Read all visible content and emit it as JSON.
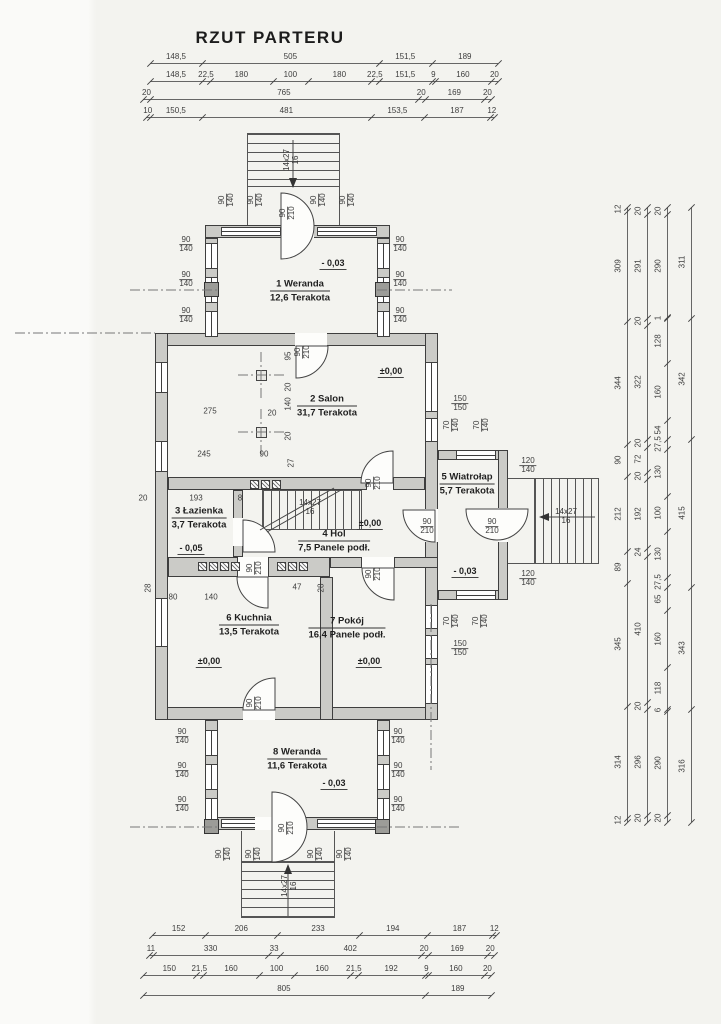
{
  "title": "RZUT PARTERU",
  "colors": {
    "line": "#3e3e3e",
    "wall_fill": "#cbcbc7",
    "paper": "#f3f3ef"
  },
  "rooms": [
    {
      "name": "1 Weranda",
      "detail": "12,6 Terakota",
      "x": 300,
      "y": 291
    },
    {
      "name": "2 Salon",
      "detail": "31,7 Terakota",
      "x": 327,
      "y": 406
    },
    {
      "name": "3 Łazienka",
      "detail": "3,7 Terakota",
      "x": 199,
      "y": 518
    },
    {
      "name": "4 Hol",
      "detail": "7,5 Panele podł.",
      "x": 334,
      "y": 541
    },
    {
      "name": "5 Wiatrołap",
      "detail": "5,7 Terakota",
      "x": 467,
      "y": 484
    },
    {
      "name": "6 Kuchnia",
      "detail": "13,5 Terakota",
      "x": 249,
      "y": 625
    },
    {
      "name": "7 Pokój",
      "detail": "16,4 Panele podł.",
      "x": 347,
      "y": 628
    },
    {
      "name": "8 Weranda",
      "detail": "11,6 Terakota",
      "x": 297,
      "y": 759
    }
  ],
  "levels": [
    {
      "text": "- 0,03",
      "x": 333,
      "y": 264
    },
    {
      "text": "±0,00",
      "x": 391,
      "y": 372
    },
    {
      "text": "- 0,05",
      "x": 191,
      "y": 549
    },
    {
      "text": "±0,00",
      "x": 370,
      "y": 524
    },
    {
      "text": "- 0,03",
      "x": 465,
      "y": 572
    },
    {
      "text": "±0,00",
      "x": 209,
      "y": 662
    },
    {
      "text": "±0,00",
      "x": 369,
      "y": 662
    },
    {
      "text": "- 0,03",
      "x": 334,
      "y": 784
    }
  ],
  "stair_labels": [
    {
      "a": "14x27",
      "b": "16",
      "x": 291,
      "y": 160,
      "r": true
    },
    {
      "a": "14x27",
      "b": "16",
      "x": 310,
      "y": 507,
      "r": false
    },
    {
      "a": "14x27",
      "b": "16",
      "x": 566,
      "y": 516,
      "r": false
    },
    {
      "a": "14x27",
      "b": "16",
      "x": 289,
      "y": 886,
      "r": true
    }
  ],
  "dimensions": {
    "chains": [
      {
        "dir": "h",
        "x": 150,
        "y": 63,
        "scale": 0.35,
        "segs": [
          "148,5",
          "505",
          "151,5",
          "189"
        ]
      },
      {
        "dir": "h",
        "x": 150,
        "y": 81,
        "scale": 0.35,
        "segs": [
          "148,5",
          "22,5",
          "180",
          "100",
          "180",
          "22,5",
          "151,5",
          "9",
          "160",
          "20"
        ]
      },
      {
        "dir": "h",
        "x": 143,
        "y": 99,
        "scale": 0.35,
        "segs": [
          "20",
          "765",
          "20",
          "169",
          "20"
        ]
      },
      {
        "dir": "h",
        "x": 146,
        "y": 117,
        "scale": 0.35,
        "segs": [
          "10",
          "150,5",
          "481",
          "153,5",
          "187",
          "12"
        ]
      },
      {
        "dir": "h",
        "x": 152,
        "y": 935,
        "scale": 0.35,
        "segs": [
          "152",
          "206",
          "233",
          "194",
          "187",
          "12"
        ]
      },
      {
        "dir": "h",
        "x": 149,
        "y": 955,
        "scale": 0.35,
        "segs": [
          "11",
          "330",
          "33",
          "402",
          "20",
          "169",
          "20"
        ]
      },
      {
        "dir": "h",
        "x": 143,
        "y": 975,
        "scale": 0.35,
        "segs": [
          "150",
          "21,5",
          "160",
          "100",
          "160",
          "21,5",
          "192",
          "9",
          "160",
          "20"
        ]
      },
      {
        "dir": "h",
        "x": 143,
        "y": 995,
        "scale": 0.35,
        "segs": [
          "805",
          "189"
        ]
      },
      {
        "dir": "v",
        "x": 628,
        "y": 207,
        "scale": 0.356,
        "segs": [
          "12",
          "309",
          "344",
          "90",
          "212",
          "89",
          "345",
          "314",
          "12"
        ]
      },
      {
        "dir": "v",
        "x": 648,
        "y": 207,
        "scale": 0.356,
        "segs": [
          "20",
          "291",
          "20",
          "322",
          "20",
          "72",
          "20",
          "192",
          "24",
          "410",
          "20",
          "296",
          "20"
        ]
      },
      {
        "dir": "v",
        "x": 668,
        "y": 207,
        "scale": 0.356,
        "segs": [
          "20",
          "290",
          "1",
          "128",
          "160",
          "54",
          "27,5",
          "130",
          "100",
          "130",
          "27,5",
          "65",
          "160",
          "118",
          "6",
          "290",
          "20"
        ]
      },
      {
        "dir": "v",
        "x": 692,
        "y": 207,
        "scale": 0.356,
        "segs": [
          "311",
          "342",
          "415",
          "343",
          "316"
        ]
      }
    ]
  },
  "openings": [
    {
      "t": "90",
      "b": "140",
      "x": 186,
      "y": 245,
      "r": false
    },
    {
      "t": "90",
      "b": "140",
      "x": 186,
      "y": 280,
      "r": false
    },
    {
      "t": "90",
      "b": "140",
      "x": 186,
      "y": 316,
      "r": false
    },
    {
      "t": "90",
      "b": "140",
      "x": 400,
      "y": 245,
      "r": false
    },
    {
      "t": "90",
      "b": "140",
      "x": 400,
      "y": 280,
      "r": false
    },
    {
      "t": "90",
      "b": "140",
      "x": 400,
      "y": 316,
      "r": false
    },
    {
      "t": "90",
      "b": "140",
      "x": 227,
      "y": 200,
      "r": true
    },
    {
      "t": "90",
      "b": "140",
      "x": 256,
      "y": 200,
      "r": true
    },
    {
      "t": "90",
      "b": "210",
      "x": 288,
      "y": 213,
      "r": true
    },
    {
      "t": "90",
      "b": "140",
      "x": 319,
      "y": 200,
      "r": true
    },
    {
      "t": "90",
      "b": "140",
      "x": 348,
      "y": 200,
      "r": true
    },
    {
      "t": "90",
      "b": "210",
      "x": 303,
      "y": 352,
      "r": true
    },
    {
      "t": "150",
      "b": "150",
      "x": 460,
      "y": 404,
      "r": false
    },
    {
      "t": "70",
      "b": "140",
      "x": 452,
      "y": 425,
      "r": true
    },
    {
      "t": "70",
      "b": "140",
      "x": 482,
      "y": 425,
      "r": true
    },
    {
      "t": "120",
      "b": "140",
      "x": 528,
      "y": 466,
      "r": false
    },
    {
      "t": "120",
      "b": "140",
      "x": 528,
      "y": 579,
      "r": false
    },
    {
      "t": "90",
      "b": "210",
      "x": 427,
      "y": 527,
      "r": false
    },
    {
      "t": "90",
      "b": "210",
      "x": 492,
      "y": 527,
      "r": false
    },
    {
      "t": "90",
      "b": "210",
      "x": 374,
      "y": 483,
      "r": true
    },
    {
      "t": "90",
      "b": "210",
      "x": 374,
      "y": 574,
      "r": true
    },
    {
      "t": "90",
      "b": "210",
      "x": 255,
      "y": 568,
      "r": true
    },
    {
      "t": "90",
      "b": "210",
      "x": 255,
      "y": 703,
      "r": true
    },
    {
      "t": "70",
      "b": "140",
      "x": 452,
      "y": 621,
      "r": true
    },
    {
      "t": "70",
      "b": "140",
      "x": 481,
      "y": 621,
      "r": true
    },
    {
      "t": "150",
      "b": "150",
      "x": 460,
      "y": 649,
      "r": false
    },
    {
      "t": "90",
      "b": "140",
      "x": 182,
      "y": 737,
      "r": false
    },
    {
      "t": "90",
      "b": "140",
      "x": 182,
      "y": 771,
      "r": false
    },
    {
      "t": "90",
      "b": "140",
      "x": 182,
      "y": 805,
      "r": false
    },
    {
      "t": "90",
      "b": "140",
      "x": 398,
      "y": 737,
      "r": false
    },
    {
      "t": "90",
      "b": "140",
      "x": 398,
      "y": 771,
      "r": false
    },
    {
      "t": "90",
      "b": "140",
      "x": 398,
      "y": 805,
      "r": false
    },
    {
      "t": "90",
      "b": "140",
      "x": 224,
      "y": 854,
      "r": true
    },
    {
      "t": "90",
      "b": "140",
      "x": 254,
      "y": 854,
      "r": true
    },
    {
      "t": "90",
      "b": "210",
      "x": 287,
      "y": 828,
      "r": true
    },
    {
      "t": "90",
      "b": "140",
      "x": 316,
      "y": 854,
      "r": true
    },
    {
      "t": "90",
      "b": "140",
      "x": 345,
      "y": 854,
      "r": true
    }
  ],
  "dims": [
    {
      "t": "275",
      "x": 210,
      "y": 411,
      "r": false
    },
    {
      "t": "20",
      "x": 272,
      "y": 413,
      "r": false
    },
    {
      "t": "245",
      "x": 204,
      "y": 454,
      "r": false
    },
    {
      "t": "90",
      "x": 264,
      "y": 454,
      "r": false
    },
    {
      "t": "95",
      "x": 288,
      "y": 356,
      "r": true
    },
    {
      "t": "20",
      "x": 288,
      "y": 387,
      "r": true
    },
    {
      "t": "140",
      "x": 288,
      "y": 404,
      "r": true
    },
    {
      "t": "20",
      "x": 288,
      "y": 436,
      "r": true
    },
    {
      "t": "27",
      "x": 291,
      "y": 463,
      "r": true
    },
    {
      "t": "193",
      "x": 196,
      "y": 498,
      "r": false
    },
    {
      "t": "8",
      "x": 240,
      "y": 498,
      "r": false
    },
    {
      "t": "20",
      "x": 143,
      "y": 498,
      "r": false
    },
    {
      "t": "28",
      "x": 148,
      "y": 588,
      "r": true
    },
    {
      "t": "80",
      "x": 173,
      "y": 597,
      "r": false
    },
    {
      "t": "140",
      "x": 211,
      "y": 597,
      "r": false
    },
    {
      "t": "47",
      "x": 297,
      "y": 587,
      "r": false
    },
    {
      "t": "28",
      "x": 321,
      "y": 588,
      "r": true
    }
  ]
}
